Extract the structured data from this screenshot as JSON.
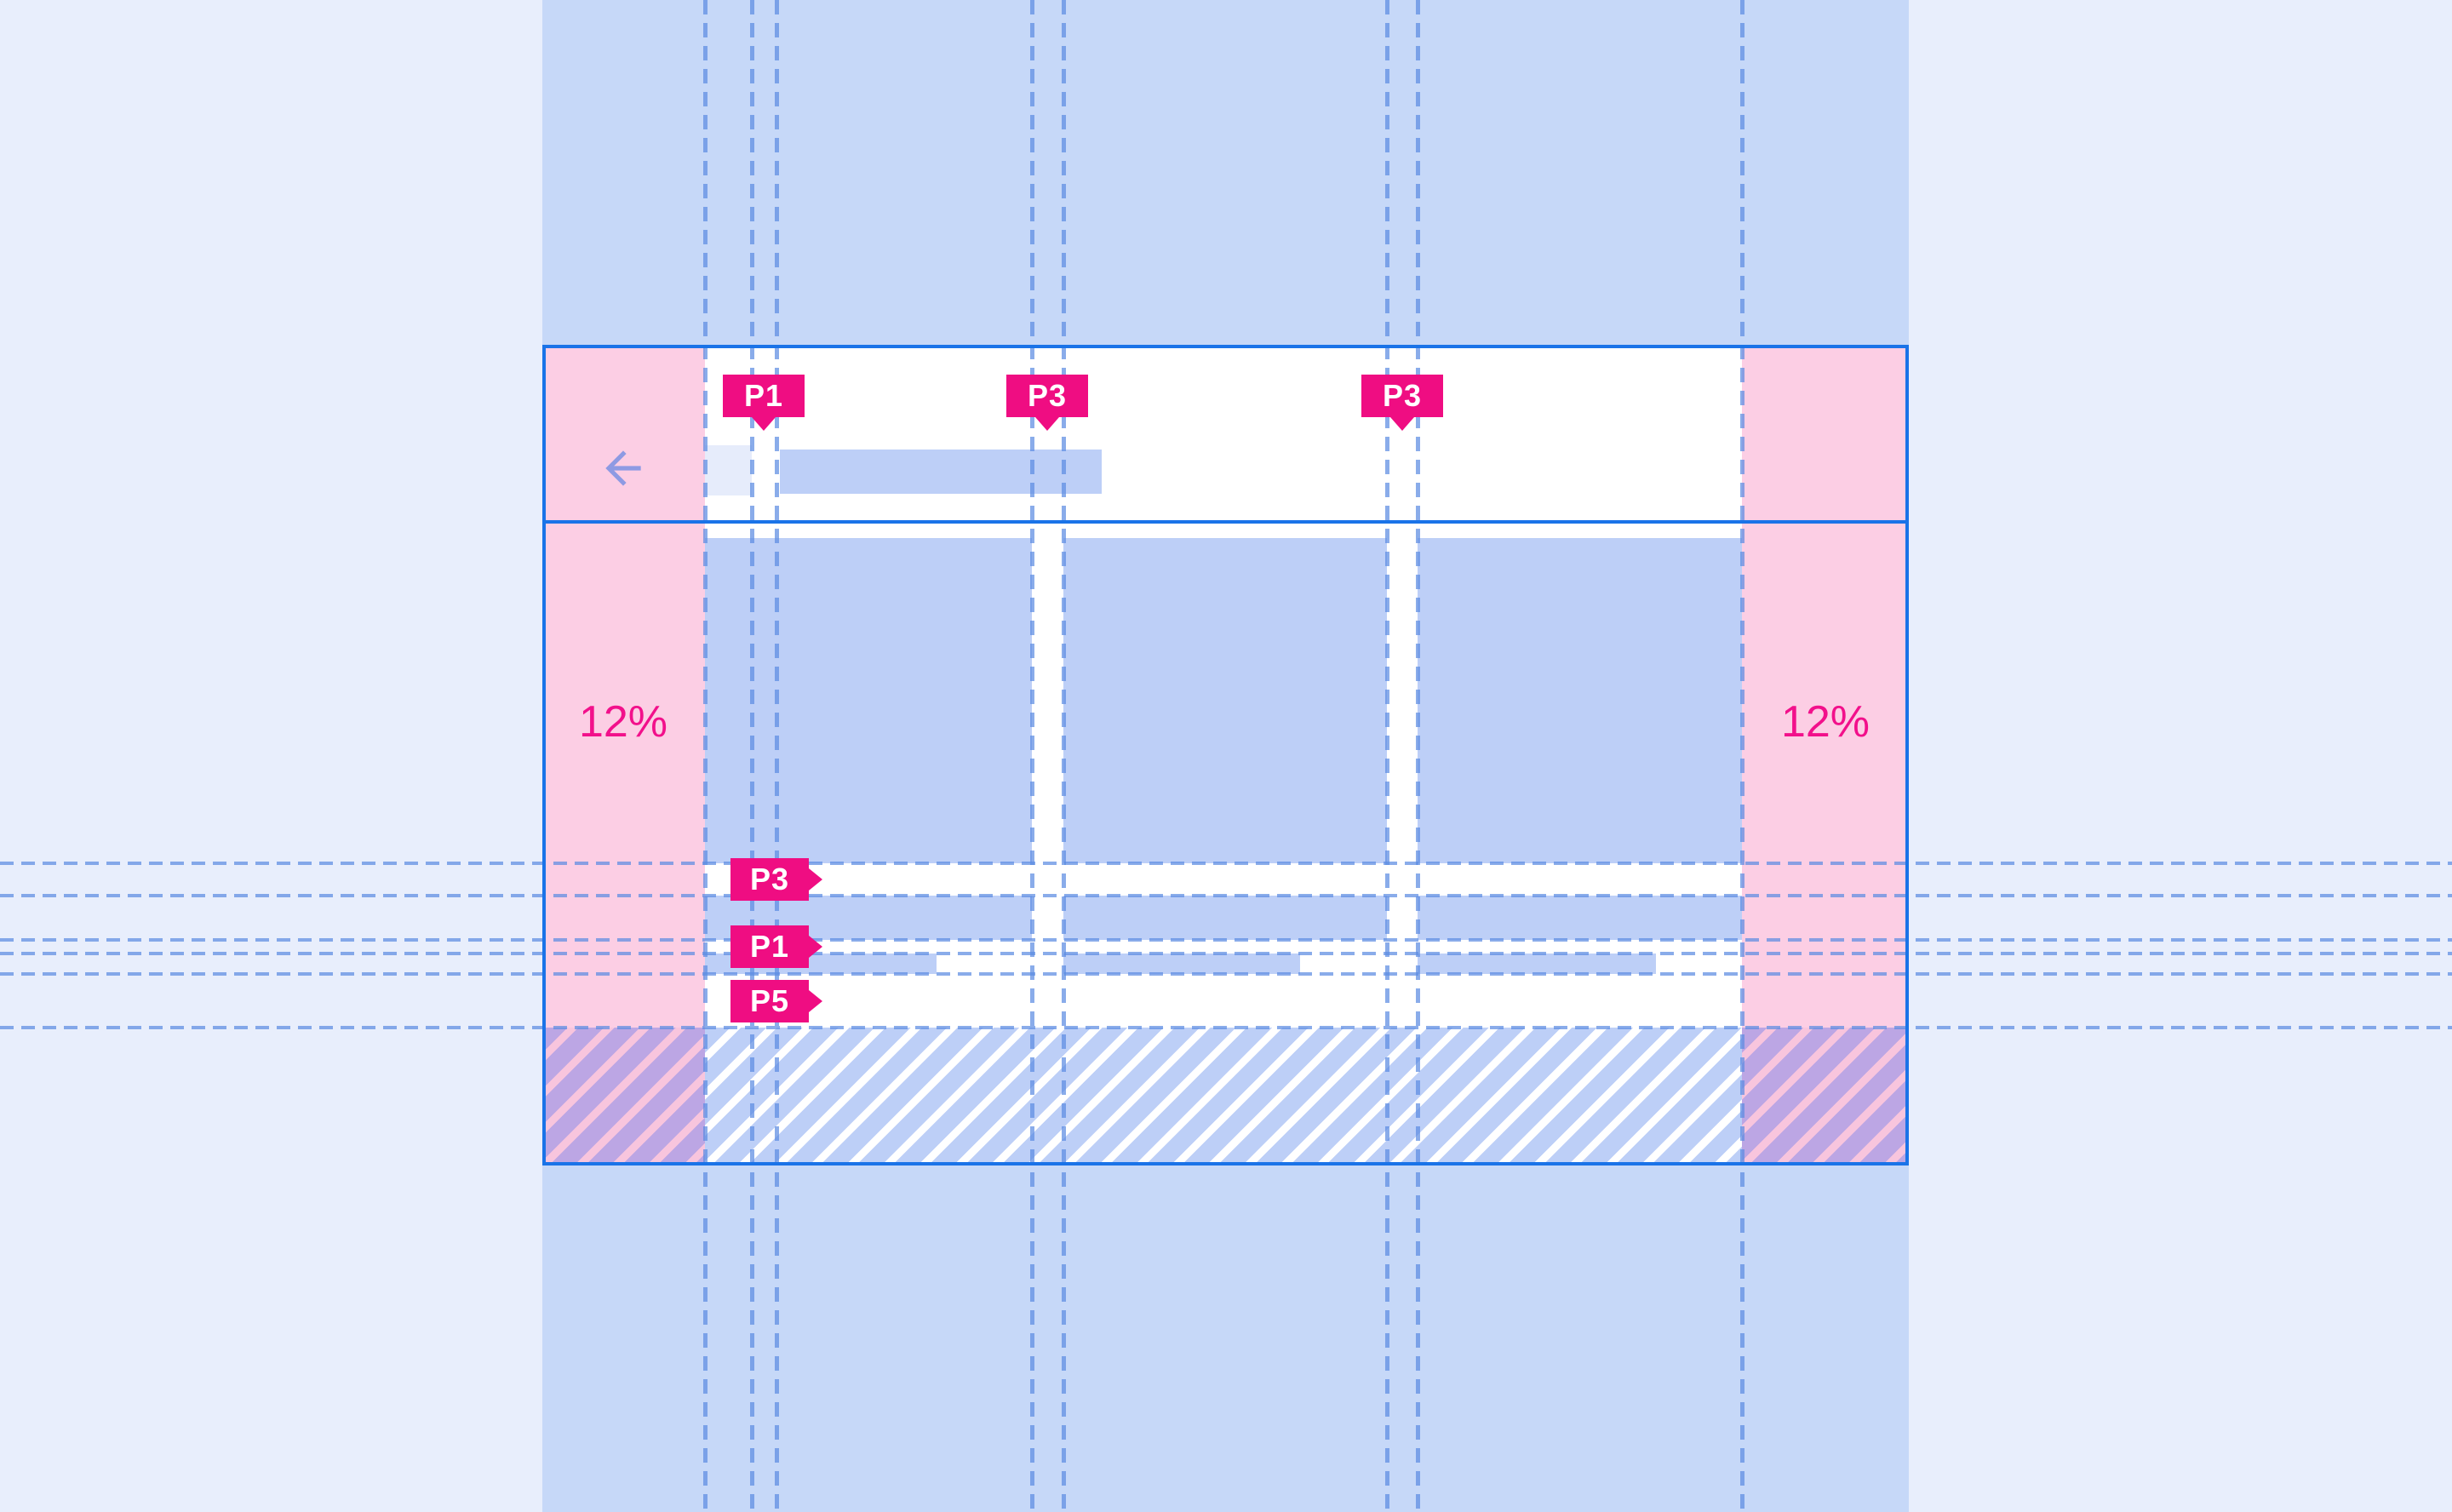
{
  "annotations": {
    "top": [
      {
        "label": "P1"
      },
      {
        "label": "P3"
      },
      {
        "label": "P3"
      }
    ],
    "left": [
      {
        "label": "P3"
      },
      {
        "label": "P1"
      },
      {
        "label": "P5"
      }
    ],
    "margins": {
      "left": "12%",
      "right": "12%"
    }
  },
  "icons": {
    "back": "arrow-back-icon"
  },
  "colors": {
    "background": "#E8EEFC",
    "band_blue": "#C6D8F8",
    "surface_white": "#FFFFFF",
    "placeholder_blue": "#BDCFF7",
    "icon_placeholder": "#E6ECFB",
    "margin_pink": "#FCCEE4",
    "annotation_magenta": "#EF0D82",
    "frame_blue": "#1A73E8",
    "guide_dash_blue": "#5C8CE2",
    "hatch_purple": "#BCA6E4",
    "hatch_pink_stripe": "#F8C5DD",
    "arrow_purple": "#8E9AE3"
  }
}
